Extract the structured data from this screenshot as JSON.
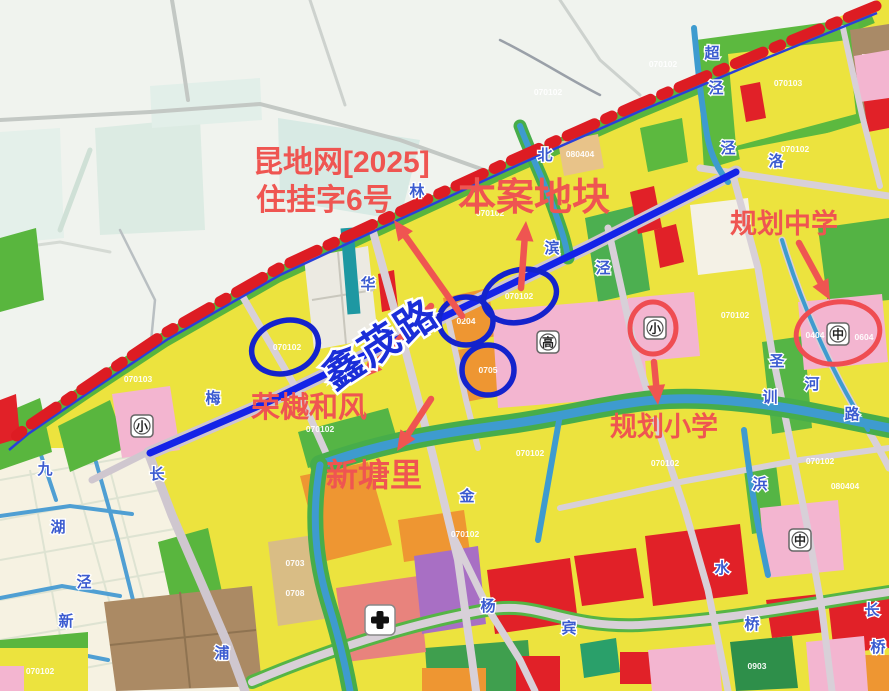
{
  "annotations": {
    "doc_line1": "昆地网[2025]",
    "doc_line2": "住挂字6号",
    "site": "本案地块",
    "middle_school": "规划中学",
    "primary_school": "规划小学",
    "project": "荣樾和风",
    "village": "新塘里",
    "road": "鑫茂路"
  },
  "palette": {
    "boundary_red": "#dd1c23",
    "boundary_blue": "#2b3fd9",
    "road_highlight_blue": "#1423e8",
    "annotation_red": "#ef5551",
    "ellipse_blue": "#1423cc",
    "circle_red": "#ef4d52",
    "parcel_yellow": "#ece33e",
    "parcel_green": "#59b63e",
    "parcel_pink": "#f3b5d0",
    "parcel_orange": "#ee9632",
    "parcel_red": "#e12128"
  },
  "parcel_codes": [
    {
      "x": 138,
      "y": 382,
      "t": "070103"
    },
    {
      "x": 320,
      "y": 432,
      "t": "070102"
    },
    {
      "x": 287,
      "y": 350,
      "t": "070102"
    },
    {
      "x": 519,
      "y": 299,
      "t": "070102"
    },
    {
      "x": 466,
      "y": 324,
      "t": "0204"
    },
    {
      "x": 488,
      "y": 373,
      "t": "0705"
    },
    {
      "x": 548,
      "y": 95,
      "t": "070102"
    },
    {
      "x": 663,
      "y": 67,
      "t": "070102"
    },
    {
      "x": 788,
      "y": 86,
      "t": "070103"
    },
    {
      "x": 795,
      "y": 152,
      "t": "070102"
    },
    {
      "x": 490,
      "y": 216,
      "t": "070102"
    },
    {
      "x": 580,
      "y": 157,
      "t": "080404"
    },
    {
      "x": 735,
      "y": 318,
      "t": "070102"
    },
    {
      "x": 665,
      "y": 466,
      "t": "070102"
    },
    {
      "x": 820,
      "y": 464,
      "t": "070102"
    },
    {
      "x": 845,
      "y": 489,
      "t": "080404"
    },
    {
      "x": 530,
      "y": 456,
      "t": "070102"
    },
    {
      "x": 465,
      "y": 537,
      "t": "070102"
    },
    {
      "x": 295,
      "y": 566,
      "t": "0703"
    },
    {
      "x": 295,
      "y": 596,
      "t": "0708"
    },
    {
      "x": 757,
      "y": 669,
      "t": "0903"
    },
    {
      "x": 40,
      "y": 674,
      "t": "070102"
    },
    {
      "x": 815,
      "y": 338,
      "t": "0404"
    },
    {
      "x": 864,
      "y": 340,
      "t": "0604"
    }
  ],
  "map_chars": [
    {
      "x": 417,
      "y": 196,
      "c": "林"
    },
    {
      "x": 368,
      "y": 289,
      "c": "华"
    },
    {
      "x": 157,
      "y": 479,
      "c": "长"
    },
    {
      "x": 66,
      "y": 626,
      "c": "新"
    },
    {
      "x": 84,
      "y": 587,
      "c": "泾"
    },
    {
      "x": 45,
      "y": 474,
      "c": "九"
    },
    {
      "x": 213,
      "y": 403,
      "c": "梅"
    },
    {
      "x": 545,
      "y": 160,
      "c": "北"
    },
    {
      "x": 712,
      "y": 58,
      "c": "超"
    },
    {
      "x": 716,
      "y": 93,
      "c": "泾"
    },
    {
      "x": 728,
      "y": 153,
      "c": "泾"
    },
    {
      "x": 776,
      "y": 166,
      "c": "洛"
    },
    {
      "x": 552,
      "y": 253,
      "c": "滨"
    },
    {
      "x": 603,
      "y": 273,
      "c": "泾"
    },
    {
      "x": 467,
      "y": 501,
      "c": "金"
    },
    {
      "x": 488,
      "y": 611,
      "c": "杨"
    },
    {
      "x": 569,
      "y": 633,
      "c": "宾"
    },
    {
      "x": 812,
      "y": 389,
      "c": "河"
    },
    {
      "x": 852,
      "y": 419,
      "c": "路"
    },
    {
      "x": 777,
      "y": 366,
      "c": "圣"
    },
    {
      "x": 770,
      "y": 402,
      "c": "训"
    },
    {
      "x": 760,
      "y": 489,
      "c": "浜"
    },
    {
      "x": 58,
      "y": 532,
      "c": "湖"
    },
    {
      "x": 222,
      "y": 658,
      "c": "浦"
    },
    {
      "x": 722,
      "y": 573,
      "c": "水"
    },
    {
      "x": 752,
      "y": 629,
      "c": "桥"
    },
    {
      "x": 872,
      "y": 615,
      "c": "长"
    },
    {
      "x": 878,
      "y": 652,
      "c": "桥"
    }
  ],
  "school_icons": [
    {
      "x": 142,
      "y": 426,
      "c": "小"
    },
    {
      "x": 655,
      "y": 328,
      "c": "小"
    },
    {
      "x": 838,
      "y": 334,
      "c": "中"
    },
    {
      "x": 548,
      "y": 342,
      "c": "高"
    },
    {
      "x": 800,
      "y": 540,
      "c": "中"
    }
  ],
  "hospital_icon": {
    "x": 380,
    "y": 620
  },
  "highlights": {
    "blue_ellipses": [
      {
        "cx": 285,
        "cy": 347,
        "rx": 34,
        "ry": 26,
        "rot": -18
      },
      {
        "cx": 520,
        "cy": 296,
        "rx": 37,
        "ry": 26,
        "rot": -14
      },
      {
        "cx": 466,
        "cy": 321,
        "rx": 27,
        "ry": 24,
        "rot": 0
      },
      {
        "cx": 488,
        "cy": 370,
        "rx": 26,
        "ry": 25,
        "rot": 0
      }
    ],
    "red_circles": [
      {
        "cx": 653,
        "cy": 328,
        "rx": 23,
        "ry": 26,
        "rot": 0
      },
      {
        "cx": 838,
        "cy": 333,
        "rx": 42,
        "ry": 31,
        "rot": -8
      }
    ]
  },
  "arrows": [
    {
      "x1": 462,
      "y1": 316,
      "x2": 394,
      "y2": 220
    },
    {
      "x1": 521,
      "y1": 288,
      "x2": 526,
      "y2": 221
    },
    {
      "x1": 799,
      "y1": 243,
      "x2": 830,
      "y2": 300
    },
    {
      "x1": 654,
      "y1": 362,
      "x2": 658,
      "y2": 405
    },
    {
      "x1": 431,
      "y1": 306,
      "x2": 362,
      "y2": 378
    },
    {
      "x1": 431,
      "y1": 399,
      "x2": 397,
      "y2": 451
    }
  ]
}
